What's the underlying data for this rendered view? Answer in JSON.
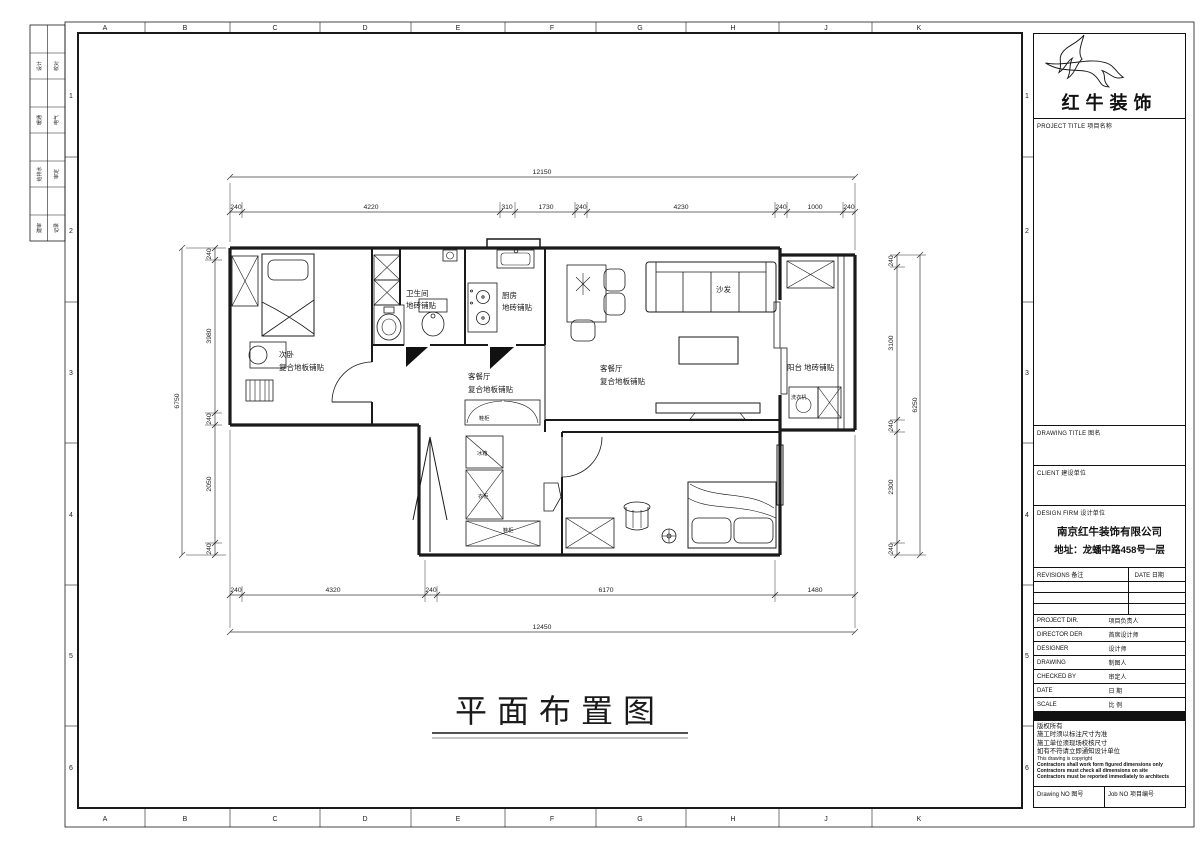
{
  "sheet": {
    "zone_letters": [
      "A",
      "B",
      "C",
      "D",
      "E",
      "F",
      "G",
      "H",
      "J",
      "K"
    ],
    "zone_numbers": [
      "1",
      "2",
      "3",
      "4",
      "5",
      "6"
    ],
    "signoff_rows": [
      {
        "c1": "设计",
        "c2": "校对"
      },
      {
        "c1": "暖通",
        "c2": "电气"
      },
      {
        "c1": "给排水",
        "c2": "审定"
      },
      {
        "c1": "建审",
        "c2": "记录"
      }
    ]
  },
  "title_block": {
    "brand_name": "红牛装饰",
    "project_title_label": "PROJECT TITLE 项目名称",
    "drawing_title_label": "DRAWING TITLE 图名",
    "client_label": "CLIENT 建设单位",
    "design_firm_label": "DESIGN FIRM 设计单位",
    "firm_name": "南京红牛装饰有限公司",
    "firm_address": "地址：龙蟠中路458号一层",
    "revisions_label": "REVISIONS 备注",
    "revisions_date_label": "DATE 日期",
    "personnel_rows": [
      {
        "en": "PROJECT DIR.",
        "cn": "项目负责人"
      },
      {
        "en": "DIRECTOR DER",
        "cn": "首席设计师"
      },
      {
        "en": "DESIGNER",
        "cn": "设计师"
      },
      {
        "en": "DRAWING",
        "cn": "制图人"
      },
      {
        "en": "CHECKED BY",
        "cn": "审定人"
      },
      {
        "en": "DATE",
        "cn": "日  期"
      },
      {
        "en": "SCALE",
        "cn": "比  例"
      }
    ],
    "copyright_notes": [
      "版权所有",
      "施工时须以标注尺寸为准",
      "施工单位须现场校核尺寸",
      "如有不符请立即通知设计单位",
      "This drawing is copyright",
      "Contractors shall work form figured dimensions only",
      "Contractors must check all dimensions on site",
      "Contractors must be reported immediately to architects"
    ],
    "drawing_no_label": "Drawing NO 图号",
    "job_no_label": "Job NO 项目编号"
  },
  "plan": {
    "drawing_title": "平面布置图",
    "rooms": {
      "bedroom1": {
        "name": "次卧",
        "finish": "复合地板铺贴"
      },
      "bathroom": {
        "name": "卫生间",
        "finish": "地砖铺贴"
      },
      "kitchen": {
        "name": "厨房",
        "finish": "地砖铺贴"
      },
      "hall": {
        "name": "客餐厅",
        "finish": "复合地板铺贴"
      },
      "living": {
        "name": "客餐厅",
        "finish": "复合地板铺贴"
      },
      "balcony": {
        "name": "阳台 地砖铺贴"
      }
    },
    "furniture": {
      "sofa": "沙发",
      "washer": "洗衣机",
      "shoe_cabinet_top": "鞋柜",
      "fridge": "冰箱",
      "cabinet": "衣柜",
      "shoe_cabinet_bottom": "鞋柜"
    },
    "dimensions": {
      "top_overall": "12150",
      "top_segments": [
        "240",
        "4220",
        "310",
        "1730",
        "240",
        "4230",
        "240",
        "1000",
        "240"
      ],
      "bottom_segments": [
        "240",
        "4320",
        "240",
        "6170",
        "1480"
      ],
      "bottom_overall": "12450",
      "left_overall": "6750",
      "left_segments": [
        "240",
        "3980",
        "240",
        "2050",
        "240"
      ],
      "right_overall": "6250",
      "right_segments": [
        "240",
        "3100",
        "240",
        "2300",
        "240"
      ]
    }
  }
}
